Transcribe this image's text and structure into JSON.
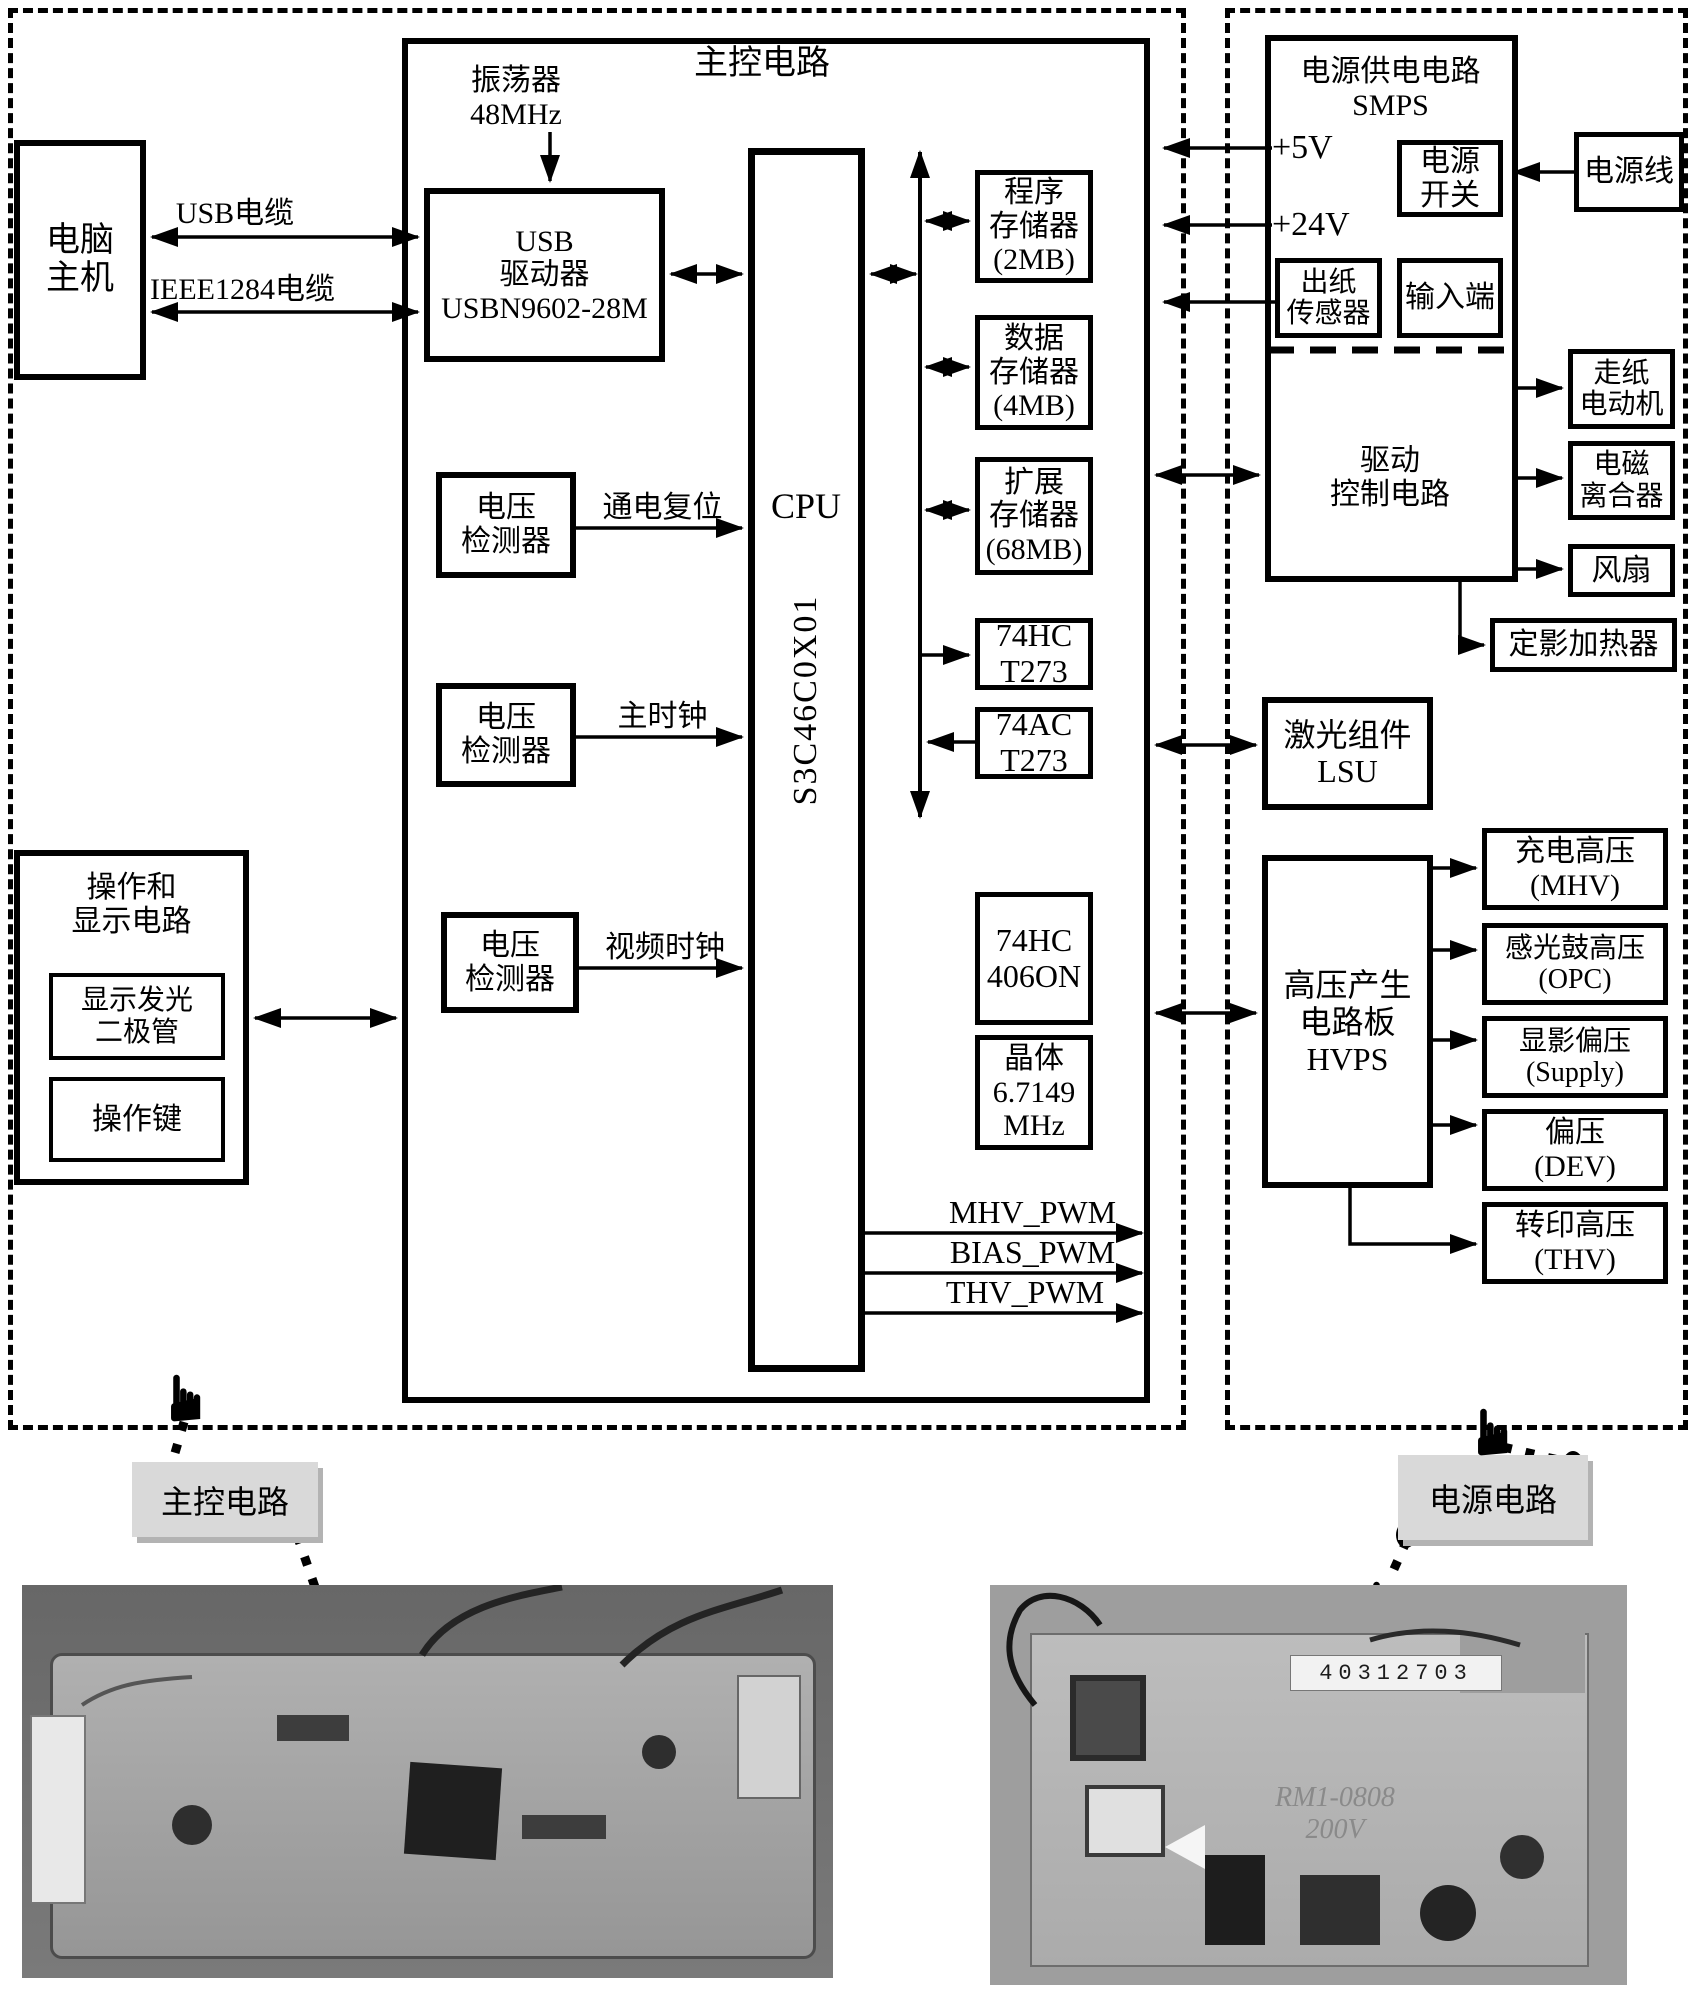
{
  "colors": {
    "ink": "#000000",
    "paper": "#ffffff",
    "note_bg": "#d9d9d9",
    "photo_left_bg": "#6f6f6f",
    "photo_right_bg": "#9e9e9e",
    "board_left": "#a9a9a9",
    "board_right": "#b9b9b9"
  },
  "icons": {
    "hand": "☛"
  },
  "main": {
    "title": "主控电路",
    "oscillator": "振荡器\n48MHz",
    "usb_driver": "USB\n驱动器\nUSBN9602-28M",
    "cpu": "CPU",
    "cpu_part": "S3C46C0X01",
    "voltage_detector_1": "电压\n检测器",
    "voltage_detector_2": "电压\n检测器",
    "voltage_detector_3": "电压\n检测器",
    "signal_power_on_reset": "通电复位",
    "signal_main_clock": "主时钟",
    "signal_video_clock": "视频时钟",
    "mem_program": "程序\n存储器\n(2MB)",
    "mem_data": "数据\n存储器\n(4MB)",
    "mem_expansion": "扩展\n存储器\n(68MB)",
    "ic_74hct273": "74HC\nT273",
    "ic_74act273": "74AC\nT273",
    "ic_74hc406on": "74HC\n406ON",
    "crystal": "晶体\n6.7149\nMHz",
    "pwm_mhv": "MHV_PWM",
    "pwm_bias": "BIAS_PWM",
    "pwm_thv": "THV_PWM"
  },
  "left": {
    "host": "电脑\n主机",
    "usb_cable": "USB电缆",
    "ieee1284_cable": "IEEE1284电缆",
    "panel_title": "操作和\n显示电路",
    "panel_led": "显示发光\n二极管",
    "panel_keys": "操作键"
  },
  "power": {
    "smps_title": "电源供电电路\nSMPS",
    "v5": "+5V",
    "v24": "+24V",
    "power_switch": "电源\n开关",
    "power_cord": "电源线",
    "paper_out_sensor": "出纸\n传感器",
    "input_terminal": "输入端",
    "drive_control": "驱动\n控制电路",
    "paper_motor": "走纸\n电动机",
    "clutch": "电磁\n离合器",
    "fan": "风扇",
    "fuser_heater": "定影加热器",
    "lsu": "激光组件\nLSU",
    "hvps": "高压产生\n电路板\nHVPS",
    "out_mhv": "充电高压\n(MHV)",
    "out_opc": "感光鼓高压\n(OPC)",
    "out_supply": "显影偏压\n(Supply)",
    "out_dev": "偏压\n(DEV)",
    "out_thv": "转印高压\n(THV)"
  },
  "notes": {
    "main_board": "主控电路",
    "power_board": "电源电路"
  },
  "photos": {
    "right_serial": "40312703",
    "right_model": "RM1-0808\n200V"
  }
}
